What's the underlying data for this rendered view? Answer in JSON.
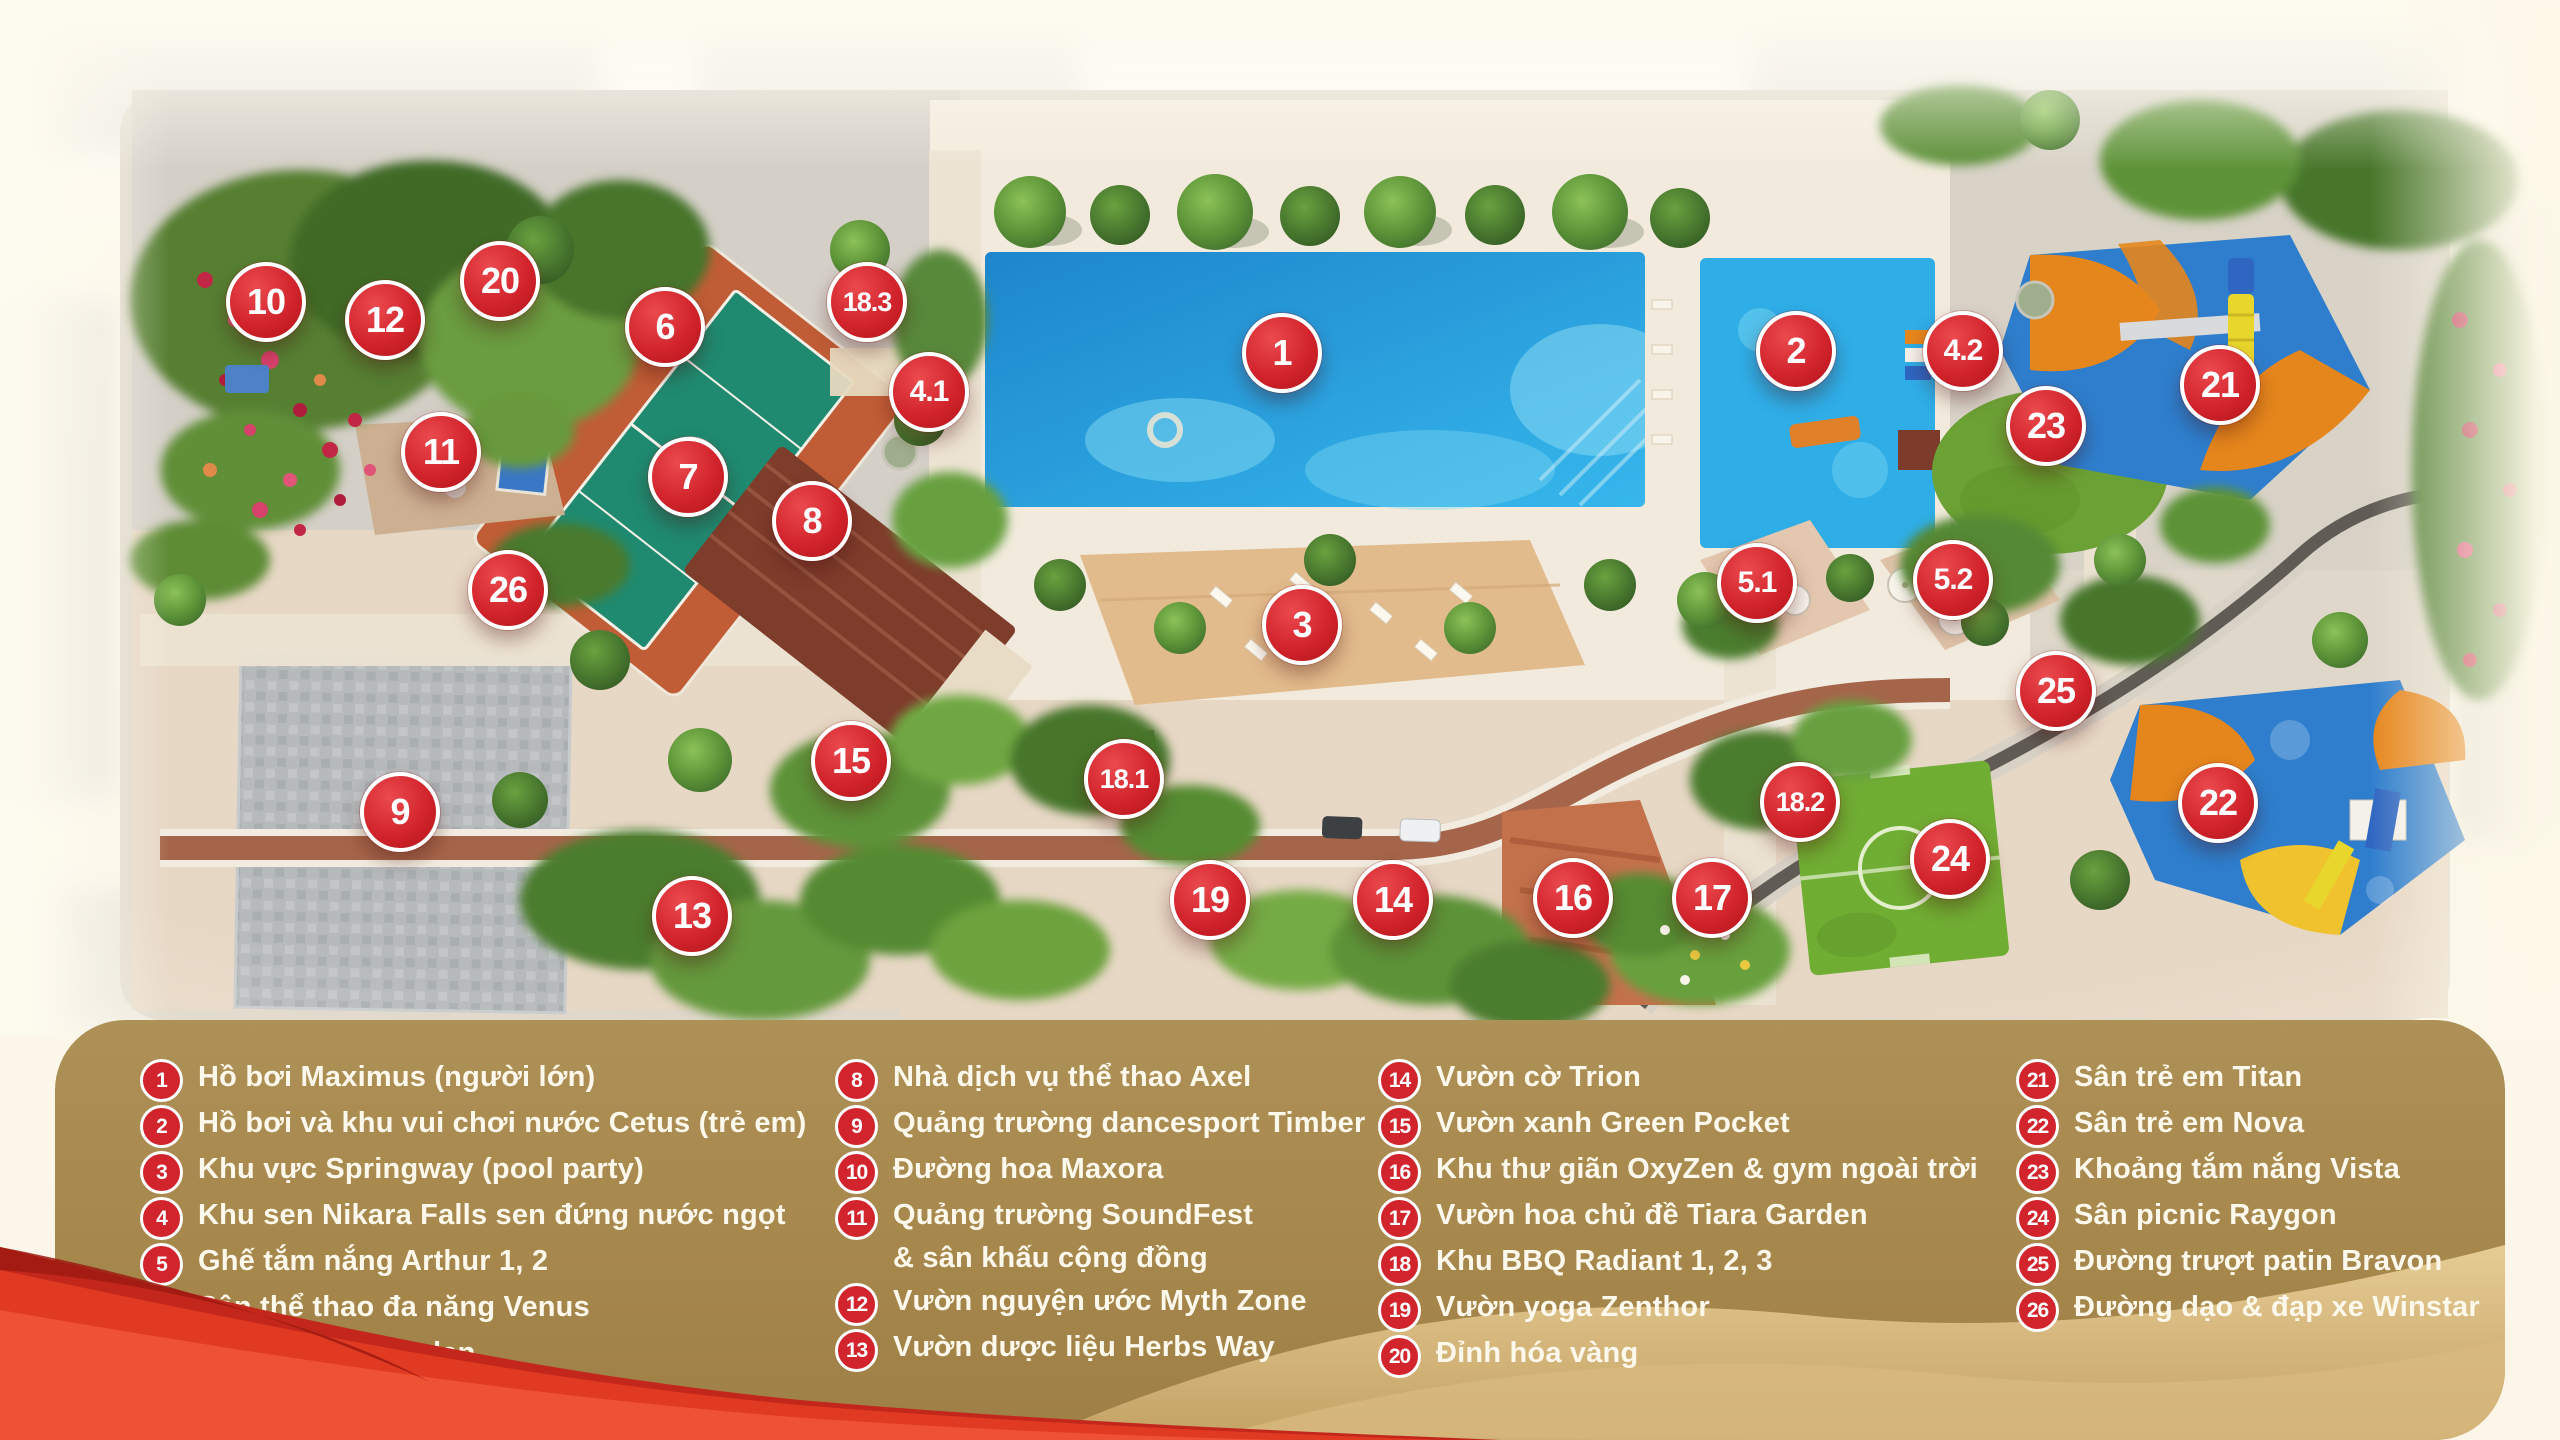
{
  "colors": {
    "marker_red": "#d2242c",
    "legend_gold": "#a6874c",
    "legend_text": "#fdf8ec",
    "pool_blue": "#2099dc",
    "kids_pool_blue": "#2fade6",
    "ribbon_red": "#e03a22",
    "dune_sand": "#d9b87c",
    "playground_blue": "#2e7ecd",
    "playground_orange": "#e5861d",
    "court_teal": "#1f8a70",
    "court_terracotta": "#c05d36"
  },
  "map": {
    "markers": [
      {
        "label": "1",
        "x": 1282,
        "y": 353
      },
      {
        "label": "2",
        "x": 1796,
        "y": 351
      },
      {
        "label": "3",
        "x": 1302,
        "y": 625
      },
      {
        "label": "4.1",
        "x": 929,
        "y": 392
      },
      {
        "label": "4.2",
        "x": 1963,
        "y": 351
      },
      {
        "label": "5.1",
        "x": 1757,
        "y": 583
      },
      {
        "label": "5.2",
        "x": 1953,
        "y": 580
      },
      {
        "label": "6",
        "x": 665,
        "y": 327
      },
      {
        "label": "7",
        "x": 688,
        "y": 477
      },
      {
        "label": "8",
        "x": 812,
        "y": 521
      },
      {
        "label": "9",
        "x": 400,
        "y": 812
      },
      {
        "label": "10",
        "x": 266,
        "y": 302
      },
      {
        "label": "11",
        "x": 441,
        "y": 452
      },
      {
        "label": "12",
        "x": 385,
        "y": 320
      },
      {
        "label": "13",
        "x": 692,
        "y": 916
      },
      {
        "label": "14",
        "x": 1393,
        "y": 900
      },
      {
        "label": "15",
        "x": 851,
        "y": 761
      },
      {
        "label": "16",
        "x": 1573,
        "y": 898
      },
      {
        "label": "17",
        "x": 1712,
        "y": 898
      },
      {
        "label": "18.1",
        "x": 1124,
        "y": 779
      },
      {
        "label": "18.2",
        "x": 1800,
        "y": 802
      },
      {
        "label": "18.3",
        "x": 867,
        "y": 302
      },
      {
        "label": "19",
        "x": 1210,
        "y": 900
      },
      {
        "label": "20",
        "x": 500,
        "y": 281
      },
      {
        "label": "21",
        "x": 2220,
        "y": 385
      },
      {
        "label": "22",
        "x": 2218,
        "y": 803
      },
      {
        "label": "23",
        "x": 2046,
        "y": 426
      },
      {
        "label": "24",
        "x": 1950,
        "y": 859
      },
      {
        "label": "25",
        "x": 2056,
        "y": 691
      },
      {
        "label": "26",
        "x": 508,
        "y": 590
      }
    ]
  },
  "legend": {
    "columns": [
      {
        "items": [
          {
            "num": "1",
            "lines": [
              "Hồ bơi Maximus (người lớn)"
            ]
          },
          {
            "num": "2",
            "lines": [
              "Hồ bơi và khu vui chơi nước Cetus (trẻ em)"
            ]
          },
          {
            "num": "3",
            "lines": [
              "Khu vực Springway (pool party)"
            ]
          },
          {
            "num": "4",
            "lines": [
              "Khu sen Nikara Falls sen đứng nước ngọt"
            ]
          },
          {
            "num": "5",
            "lines": [
              "Ghế tắm nắng Arthur 1, 2"
            ]
          },
          {
            "num": "6",
            "lines": [
              "Sân thể thao đa năng Venus"
            ]
          },
          {
            "num": "7",
            "lines": [
              "Sân bóng rổ Jordan"
            ]
          }
        ]
      },
      {
        "items": [
          {
            "num": "8",
            "lines": [
              "Nhà dịch vụ thể thao Axel"
            ]
          },
          {
            "num": "9",
            "lines": [
              "Quảng trường dancesport Timber"
            ]
          },
          {
            "num": "10",
            "lines": [
              "Đường hoa Maxora"
            ]
          },
          {
            "num": "11",
            "lines": [
              "Quảng trường SoundFest",
              "& sân khấu cộng đồng"
            ]
          },
          {
            "num": "12",
            "lines": [
              "Vườn nguyện ước Myth Zone"
            ]
          },
          {
            "num": "13",
            "lines": [
              "Vườn dược liệu Herbs Way"
            ]
          }
        ]
      },
      {
        "items": [
          {
            "num": "14",
            "lines": [
              "Vườn cờ Trion"
            ]
          },
          {
            "num": "15",
            "lines": [
              "Vườn xanh Green Pocket"
            ]
          },
          {
            "num": "16",
            "lines": [
              "Khu thư giãn OxyZen & gym ngoài trời"
            ]
          },
          {
            "num": "17",
            "lines": [
              "Vườn hoa chủ đề Tiara Garden"
            ]
          },
          {
            "num": "18",
            "lines": [
              "Khu BBQ Radiant 1, 2, 3"
            ]
          },
          {
            "num": "19",
            "lines": [
              "Vườn yoga Zenthor"
            ]
          },
          {
            "num": "20",
            "lines": [
              "Đỉnh hóa vàng"
            ]
          }
        ]
      },
      {
        "items": [
          {
            "num": "21",
            "lines": [
              "Sân trẻ em Titan"
            ]
          },
          {
            "num": "22",
            "lines": [
              "Sân trẻ em Nova"
            ]
          },
          {
            "num": "23",
            "lines": [
              "Khoảng tắm nắng Vista"
            ]
          },
          {
            "num": "24",
            "lines": [
              "Sân picnic Raygon"
            ]
          },
          {
            "num": "25",
            "lines": [
              "Đường trượt patin Bravon"
            ]
          },
          {
            "num": "26",
            "lines": [
              "Đường dạo & đạp xe Winstar"
            ]
          }
        ]
      }
    ]
  }
}
